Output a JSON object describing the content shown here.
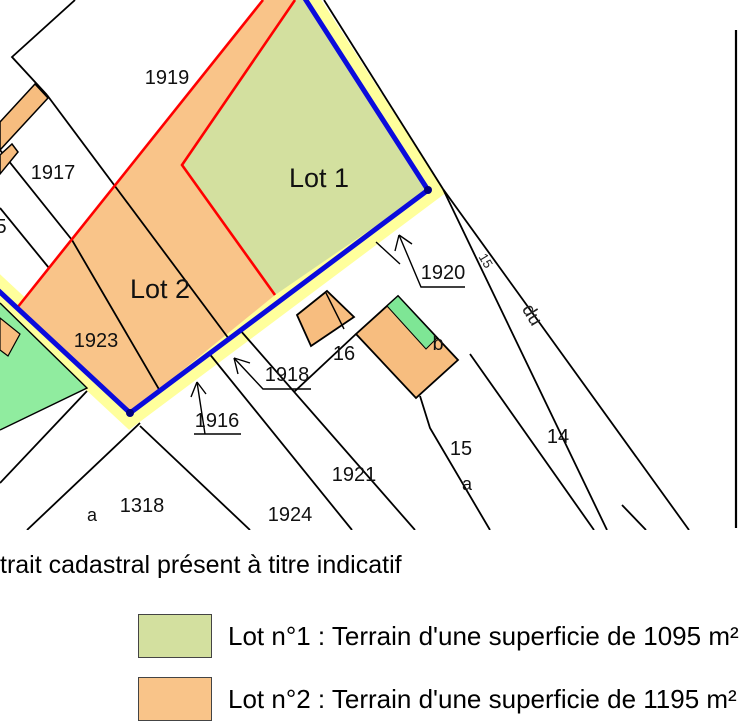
{
  "map": {
    "colors": {
      "lot1_green": "#d3e09f",
      "lot2_orange": "#f9c489",
      "highlight_yellow": "#ffff9c",
      "boundary_blue": "#0b0bdc",
      "corner_dot_blue": "#000080",
      "division_red": "#ff0000",
      "building_orange": "#f7bd7f",
      "building_green": "#7ee695",
      "parcel_green": "#90ec9f"
    },
    "lot_labels": {
      "lot1": "Lot 1",
      "lot2": "Lot 2"
    },
    "parcel_labels": {
      "p1919": "1919",
      "p1917": "1917",
      "p5": "5",
      "p1923": "1923",
      "p16": "16",
      "p1921": "1921",
      "p1924": "1924",
      "p1318": "1318",
      "p1318_sub": "a",
      "p15": "15",
      "p15_sub": "a",
      "p14": "14",
      "building_sub": "b"
    },
    "arrow_labels": {
      "a1920": "1920",
      "a1918": "1918",
      "a1916": "1916"
    },
    "road_labels": {
      "r15": "15",
      "r_du": "du"
    }
  },
  "caption": "trait cadastral présent à titre indicatif",
  "legend": {
    "items": [
      {
        "label": "Lot n°1 : Terrain d'une superficie de 1095 m²",
        "swatch_color": "#d3e09f"
      },
      {
        "label": "Lot n°2 : Terrain d'une superficie de 1195 m²",
        "swatch_color": "#f9c489"
      }
    ]
  }
}
